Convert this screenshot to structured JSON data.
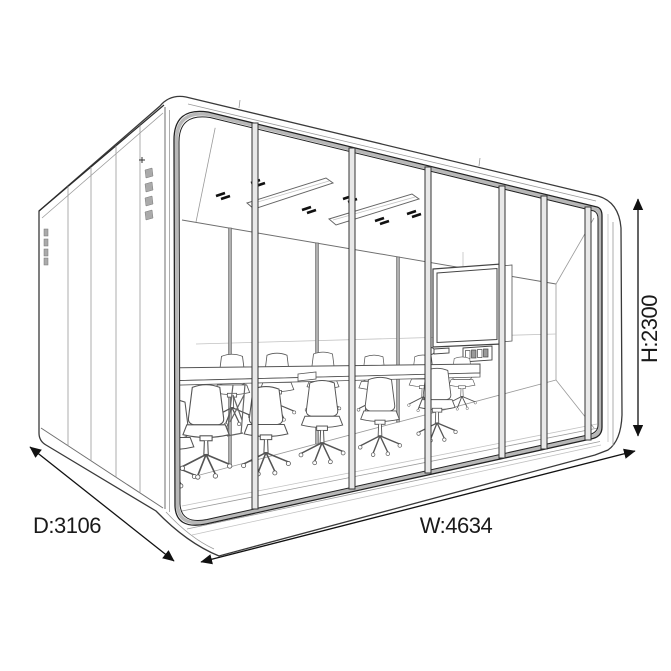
{
  "diagram": {
    "type": "isometric-product-line-drawing",
    "subject": "glass-walled meeting pod with conference table, chairs, TV screen and ceiling lights",
    "dimension_labels": {
      "depth": "D:3106",
      "width": "W:4634",
      "height": "H:2300"
    },
    "colors": {
      "background": "#ffffff",
      "line": "#2a2a2a",
      "frame_gray": "#b8b8b8",
      "text": "#1a1a1a"
    },
    "counts": {
      "front_glass_mullions": 6,
      "rear_wall_mullions": 3,
      "front_row_chairs": 6,
      "rear_row_chairs": 6,
      "ceiling_lights": 2,
      "ceiling_vent_marks": 6,
      "side_wall_vent_groups": 2
    }
  }
}
